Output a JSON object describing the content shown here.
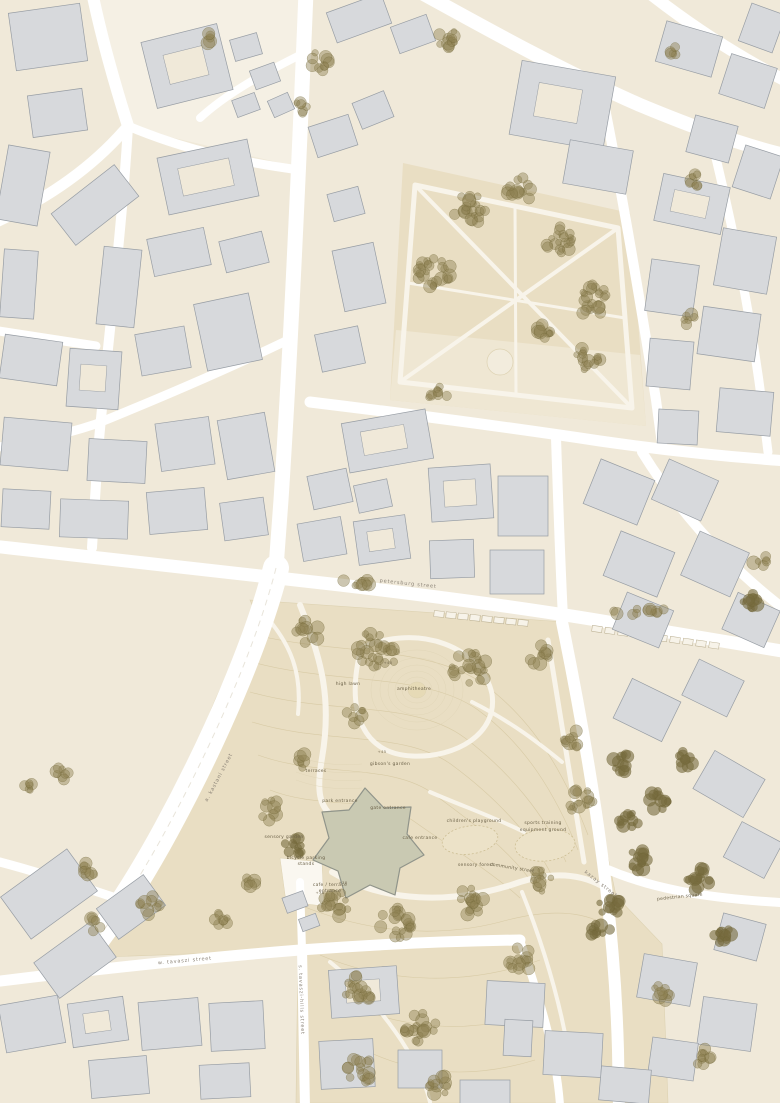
{
  "palette": {
    "block": "#f0e9d9",
    "block_pale": "#f5f0e4",
    "building": "#d7d9dc",
    "building_outline": "#979da4",
    "street": "#ffffff",
    "park": "#e9dec3",
    "park_light": "#efe7d3",
    "tree": "#8d8051",
    "tree_dark": "#776b3e",
    "pond": "#c9c9b2",
    "pond_outline": "#90948a",
    "contour": "#d5c7a0",
    "label": "#6b6148",
    "street_label": "#8b8377"
  },
  "map": {
    "labels": [
      {
        "text": "petersburg street"
      },
      {
        "text": "a. kastani street"
      },
      {
        "text": "kazay street"
      },
      {
        "text": "w. tavaszi street"
      },
      {
        "text": "s. tavaszi-hills street"
      },
      {
        "text": "pedestrian square"
      },
      {
        "text": "high lawn"
      },
      {
        "text": "amphitheatre"
      },
      {
        "text": "terraces"
      },
      {
        "text": "gibson's garden"
      },
      {
        "text": "park entrance"
      },
      {
        "text": "gate entrance"
      },
      {
        "text": "cafe entrance"
      },
      {
        "text": "children's playground"
      },
      {
        "text": "sports training"
      },
      {
        "text": "equipment ground"
      },
      {
        "text": "sensory garden"
      },
      {
        "text": "bicycle parking"
      },
      {
        "text": "stands"
      },
      {
        "text": "cafe / terrace"
      },
      {
        "text": "entrance"
      },
      {
        "text": "community street"
      },
      {
        "text": "sensory forest"
      },
      {
        "text": "+40"
      },
      {
        "text": "+45"
      },
      {
        "text": "+38"
      },
      {
        "text": "+36"
      }
    ],
    "tree_clusters": [
      {
        "x": 432,
        "y": 270,
        "n": 26,
        "s": 38
      },
      {
        "x": 470,
        "y": 210,
        "n": 22,
        "s": 34
      },
      {
        "x": 520,
        "y": 190,
        "n": 14,
        "s": 26
      },
      {
        "x": 560,
        "y": 240,
        "n": 20,
        "s": 30
      },
      {
        "x": 592,
        "y": 300,
        "n": 22,
        "s": 32
      },
      {
        "x": 588,
        "y": 360,
        "n": 16,
        "s": 26
      },
      {
        "x": 545,
        "y": 330,
        "n": 10,
        "s": 20
      },
      {
        "x": 438,
        "y": 395,
        "n": 9,
        "s": 20
      },
      {
        "x": 318,
        "y": 62,
        "n": 10,
        "s": 22
      },
      {
        "x": 448,
        "y": 38,
        "n": 12,
        "s": 22
      },
      {
        "x": 300,
        "y": 108,
        "n": 6,
        "s": 14
      },
      {
        "x": 210,
        "y": 38,
        "n": 5,
        "s": 12
      },
      {
        "x": 695,
        "y": 182,
        "n": 8,
        "s": 16
      },
      {
        "x": 672,
        "y": 52,
        "n": 5,
        "s": 12
      },
      {
        "x": 690,
        "y": 320,
        "n": 6,
        "s": 14
      },
      {
        "x": 358,
        "y": 583,
        "n": 9,
        "s": 36,
        "row": true
      },
      {
        "x": 640,
        "y": 612,
        "n": 12,
        "s": 60,
        "row": true
      },
      {
        "x": 308,
        "y": 632,
        "n": 12,
        "s": 26
      },
      {
        "x": 378,
        "y": 650,
        "n": 30,
        "s": 42
      },
      {
        "x": 470,
        "y": 668,
        "n": 22,
        "s": 36
      },
      {
        "x": 540,
        "y": 655,
        "n": 10,
        "s": 22
      },
      {
        "x": 355,
        "y": 715,
        "n": 8,
        "s": 18
      },
      {
        "x": 302,
        "y": 760,
        "n": 6,
        "s": 16
      },
      {
        "x": 270,
        "y": 810,
        "n": 10,
        "s": 22
      },
      {
        "x": 295,
        "y": 845,
        "n": 12,
        "s": 20,
        "dark": true
      },
      {
        "x": 335,
        "y": 905,
        "n": 16,
        "s": 28
      },
      {
        "x": 395,
        "y": 925,
        "n": 20,
        "s": 34
      },
      {
        "x": 470,
        "y": 900,
        "n": 18,
        "s": 30
      },
      {
        "x": 540,
        "y": 880,
        "n": 12,
        "s": 24
      },
      {
        "x": 580,
        "y": 800,
        "n": 14,
        "s": 26
      },
      {
        "x": 572,
        "y": 740,
        "n": 10,
        "s": 20
      },
      {
        "x": 600,
        "y": 930,
        "n": 10,
        "s": 20,
        "dark": true
      },
      {
        "x": 360,
        "y": 990,
        "n": 18,
        "s": 30
      },
      {
        "x": 420,
        "y": 1030,
        "n": 20,
        "s": 34
      },
      {
        "x": 360,
        "y": 1070,
        "n": 16,
        "s": 28
      },
      {
        "x": 440,
        "y": 1085,
        "n": 12,
        "s": 24
      },
      {
        "x": 520,
        "y": 960,
        "n": 14,
        "s": 26
      },
      {
        "x": 610,
        "y": 905,
        "n": 12,
        "s": 22,
        "dark": true
      },
      {
        "x": 640,
        "y": 860,
        "n": 14,
        "s": 24,
        "dark": true
      },
      {
        "x": 660,
        "y": 800,
        "n": 12,
        "s": 22,
        "dark": true
      },
      {
        "x": 684,
        "y": 758,
        "n": 10,
        "s": 20,
        "dark": true
      },
      {
        "x": 700,
        "y": 880,
        "n": 16,
        "s": 26,
        "dark": true
      },
      {
        "x": 722,
        "y": 932,
        "n": 12,
        "s": 22,
        "dark": true
      },
      {
        "x": 660,
        "y": 992,
        "n": 10,
        "s": 20
      },
      {
        "x": 702,
        "y": 1058,
        "n": 10,
        "s": 20
      },
      {
        "x": 622,
        "y": 762,
        "n": 12,
        "s": 20,
        "dark": true
      },
      {
        "x": 628,
        "y": 822,
        "n": 12,
        "s": 20,
        "dark": true
      },
      {
        "x": 748,
        "y": 602,
        "n": 10,
        "s": 20,
        "dark": true
      },
      {
        "x": 760,
        "y": 560,
        "n": 6,
        "s": 14
      },
      {
        "x": 60,
        "y": 775,
        "n": 8,
        "s": 18
      },
      {
        "x": 30,
        "y": 790,
        "n": 6,
        "s": 14
      },
      {
        "x": 90,
        "y": 870,
        "n": 8,
        "s": 16
      },
      {
        "x": 150,
        "y": 905,
        "n": 10,
        "s": 20
      },
      {
        "x": 220,
        "y": 920,
        "n": 8,
        "s": 16
      },
      {
        "x": 252,
        "y": 880,
        "n": 6,
        "s": 14
      },
      {
        "x": 95,
        "y": 925,
        "n": 6,
        "s": 20
      }
    ],
    "parking_rows": [
      {
        "x": 434,
        "y": 611,
        "n": 8,
        "dx": 12,
        "rot": 6
      },
      {
        "x": 592,
        "y": 626,
        "n": 10,
        "dx": 13,
        "rot": 8
      }
    ]
  }
}
